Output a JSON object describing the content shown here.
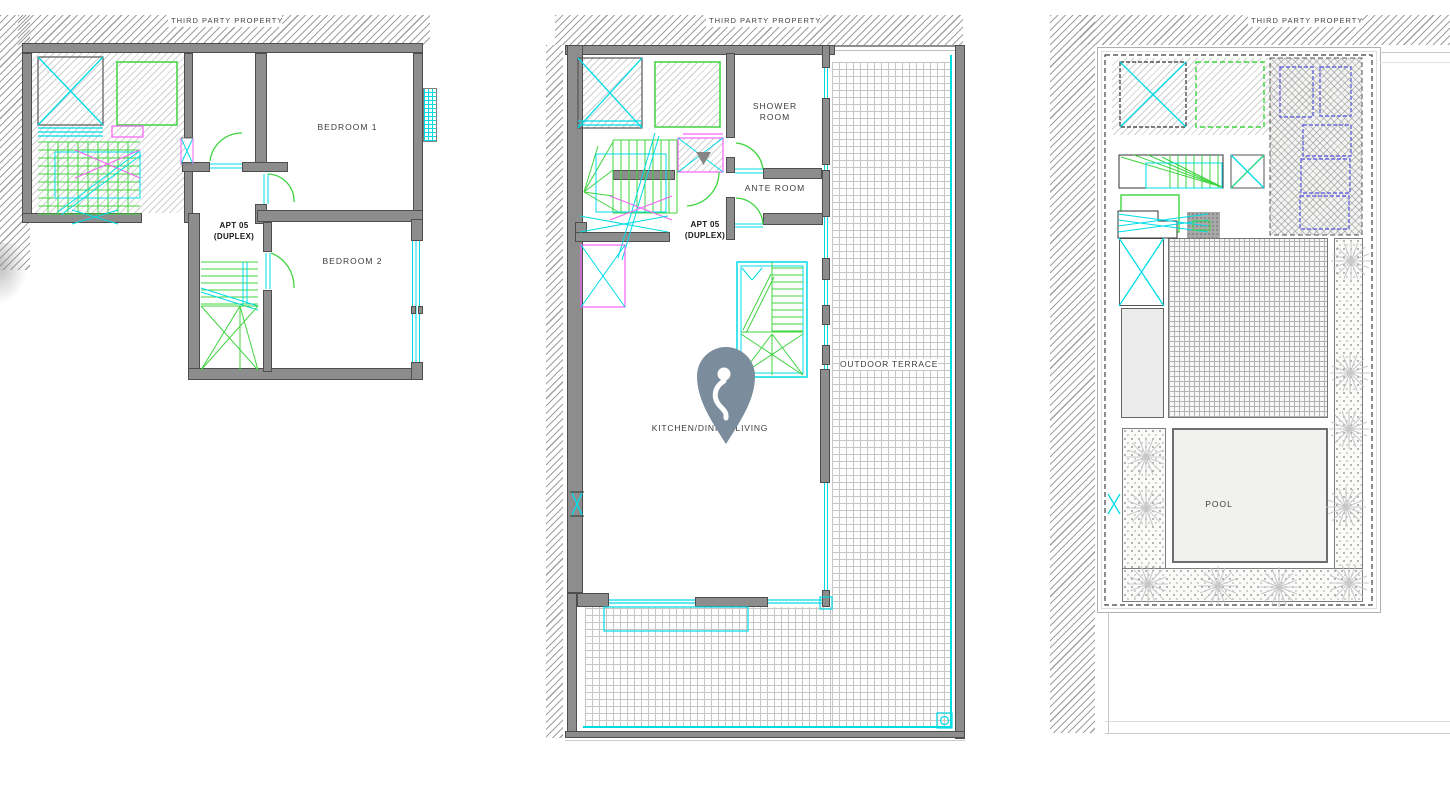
{
  "plans": {
    "lower": {
      "boundary_label": "THIRD PARTY PROPERTY",
      "labels": {
        "bedroom1": "BEDROOM 1",
        "bedroom2": "BEDROOM 2",
        "apt_line1": "APT 05",
        "apt_line2": "(DUPLEX)"
      }
    },
    "upper": {
      "boundary_label": "THIRD PARTY PROPERTY",
      "labels": {
        "shower_line1": "SHOWER",
        "shower_line2": "ROOM",
        "ante_room": "ANTE ROOM",
        "apt_line1": "APT 05",
        "apt_line2": "(DUPLEX)",
        "kitchen": "KITCHEN/DINING/LIVING",
        "outdoor_terrace": "OUTDOOR TERRACE"
      }
    },
    "roof": {
      "boundary_label": "THIRD PARTY PROPERTY",
      "labels": {
        "pool": "POOL"
      }
    }
  },
  "icons": {
    "location_pin": "map-pin-marker",
    "plant": "plant-symbol"
  },
  "colors": {
    "wall": "#8d8d8d",
    "cyan": "#00dce6",
    "green": "#3fd43f",
    "magenta": "#f861f8",
    "panel_blue": "#6a6ae0",
    "pin": "#7b8c9d",
    "hatch": "#a0a0a0"
  }
}
